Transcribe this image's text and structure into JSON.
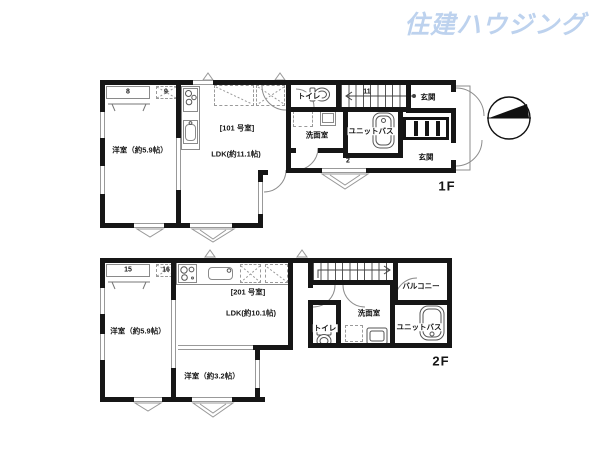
{
  "logo": {
    "text": "住建ハウジング",
    "color": "#bdd2ee"
  },
  "icons": {
    "north_compass": "circle-with-north-triangle"
  },
  "f1": {
    "floor_label": "1F",
    "unit_label": "[101 号室]",
    "ldk_label": "LDK(約11.1帖)",
    "west_room_label": "洋室（約5.9帖）",
    "toilet_label": "トイレ",
    "entrance_top_label": "玄関",
    "entrance_bottom_label": "玄関",
    "washroom_label": "洗面室",
    "unit_bath_label": "ユニットバス",
    "marker_8": "8",
    "marker_9": "9",
    "marker_11": "11",
    "marker_2": "2"
  },
  "f2": {
    "floor_label": "2F",
    "unit_label": "[201 号室]",
    "ldk_label": "LDK(約10.1帖)",
    "west_room_59_label": "洋室（約5.9帖）",
    "west_room_32_label": "洋室（約3.2帖）",
    "balcony_label": "バルコニー",
    "toilet_label": "トイレ",
    "washroom_label": "洗面室",
    "unit_bath_label": "ユニットバス",
    "marker_15": "15",
    "marker_16": "16"
  }
}
